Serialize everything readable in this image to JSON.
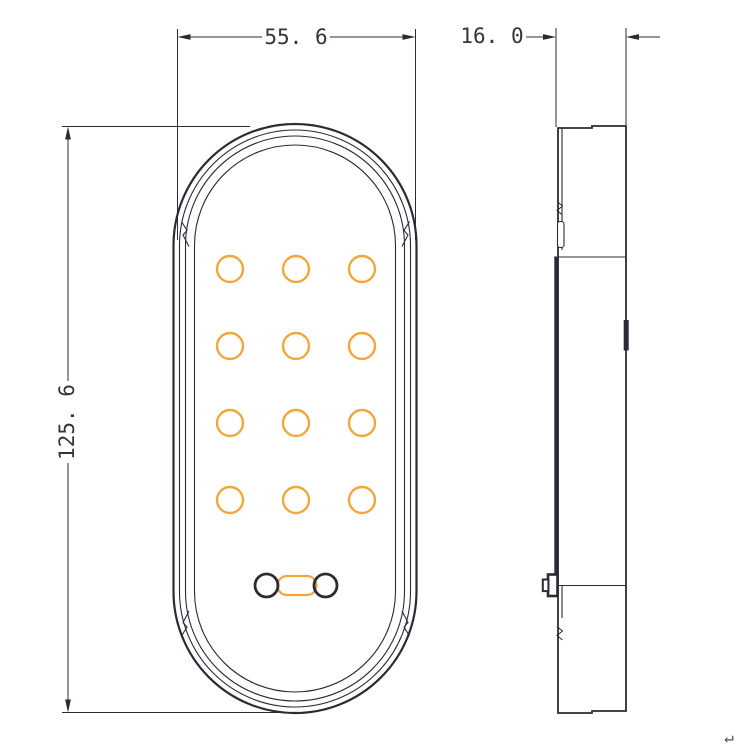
{
  "canvas": {
    "width": 750,
    "height": 750,
    "background": "#ffffff"
  },
  "colors": {
    "line": "#2b2b36",
    "accent": "#F2A63C",
    "text": "#34343f",
    "glyph": "#50505a",
    "white": "#ffffff"
  },
  "labels": {
    "width": "55. 6",
    "depth": "16. 0",
    "height": "125. 6",
    "return_glyph": "↵"
  },
  "views": [
    {
      "name": "front-view",
      "shapes": [
        {
          "t": "rect",
          "n": "front-outer-outline",
          "x": 173.5,
          "y": 124,
          "w": 243,
          "h": 589,
          "rx": 121.5,
          "sw": 2.2
        },
        {
          "t": "rect",
          "n": "front-outline-inner",
          "x": 179.5,
          "y": 130,
          "w": 231,
          "h": 577,
          "rx": 115.5,
          "sw": 1.1
        },
        {
          "t": "rect",
          "n": "front-bezel-outline",
          "x": 185.5,
          "y": 136,
          "w": 219,
          "h": 565,
          "rx": 109.5,
          "sw": 1.1
        },
        {
          "t": "rect",
          "n": "front-lens-outline",
          "x": 194.5,
          "y": 145,
          "w": 201,
          "h": 547,
          "rx": 100.5,
          "sw": 1.1
        },
        {
          "t": "path",
          "n": "front-clip-notch-top-left",
          "d": "M181.5 221.5 l5.5 9 l-4 4.5 l6 11.5",
          "sw": 1.1
        },
        {
          "t": "path",
          "n": "front-clip-notch-top-right",
          "d": "M409.5 221.5 l-5.5 9 l4 4.5 l-6 11.5",
          "sw": 1.1
        },
        {
          "t": "path",
          "n": "front-clip-notch-bottom-left",
          "d": "M181.5 636 l5.5 -9 l-4 -4.5 l6 -11.5",
          "sw": 1.1
        },
        {
          "t": "path",
          "n": "front-clip-notch-bottom-right",
          "d": "M409.5 636 l-5.5 -9 l4 -4.5 l-6 -11.5",
          "sw": 1.1
        },
        {
          "t": "led-grid",
          "n": "led-circle",
          "cols": [
            230,
            296,
            362
          ],
          "rows": [
            269,
            346,
            423,
            500
          ],
          "r": 13,
          "sw": 2.4,
          "stroke": "accent"
        },
        {
          "t": "rect",
          "n": "connector-link",
          "x": 277.5,
          "y": 576,
          "w": 39,
          "h": 19,
          "rx": 9.5,
          "sw": 2.2,
          "stroke": "accent"
        },
        {
          "t": "circle",
          "n": "connector-terminal-left",
          "cx": 266.5,
          "cy": 585.5,
          "r": 11.5,
          "sw": 2.8
        },
        {
          "t": "circle",
          "n": "connector-terminal-right",
          "cx": 325.5,
          "cy": 585.5,
          "r": 11.5,
          "sw": 2.8
        }
      ]
    },
    {
      "name": "side-view",
      "shapes": [
        {
          "t": "path",
          "n": "side-outer-outline",
          "d": "M558 128 L592 128 L592 126 L626 126 L626 711 L592 711 L592 713 L558 713 Z",
          "sw": 1.8
        },
        {
          "t": "line",
          "n": "side-inner-edge-top",
          "x1": 562,
          "y1": 128,
          "x2": 562,
          "y2": 250,
          "sw": 1.1
        },
        {
          "t": "line",
          "n": "side-inner-edge-bottom",
          "x1": 562,
          "y1": 586,
          "x2": 562,
          "y2": 618,
          "sw": 1.1
        },
        {
          "t": "path",
          "n": "side-notch-top",
          "d": "M557 201.5 l5.5 4.5 l-5.5 4.5 l5.5 4.5",
          "sw": 1
        },
        {
          "t": "rect",
          "n": "side-clip-slot",
          "x": 557.5,
          "y": 221.5,
          "w": 6.5,
          "h": 26,
          "rx": 2.5,
          "sw": 1.1,
          "fill": "white"
        },
        {
          "t": "rect",
          "n": "side-lens-edge",
          "x": 554.3,
          "y": 257,
          "w": 4.4,
          "h": 328.5,
          "fill": "line",
          "sw": 0
        },
        {
          "t": "line",
          "n": "side-seam-top",
          "x1": 554.3,
          "y1": 257,
          "x2": 626,
          "y2": 257,
          "sw": 1.1
        },
        {
          "t": "line",
          "n": "side-seam-bottom",
          "x1": 548.5,
          "y1": 585.5,
          "x2": 626,
          "y2": 585.5,
          "sw": 1.1
        },
        {
          "t": "rect",
          "n": "side-right-tick",
          "x": 623.7,
          "y": 320,
          "w": 5,
          "h": 30.5,
          "fill": "line",
          "sw": 0
        },
        {
          "t": "rect",
          "n": "side-screw-boss",
          "x": 548,
          "y": 574.5,
          "w": 9.5,
          "h": 21.5,
          "sw": 2.6,
          "fill": "white"
        },
        {
          "t": "rect",
          "n": "side-screw-head",
          "x": 542.8,
          "y": 579.5,
          "w": 5.6,
          "h": 11.6,
          "sw": 2,
          "fill": "white"
        },
        {
          "t": "path",
          "n": "side-notch-bottom",
          "d": "M557 626.5 l5.5 4.5 l-5.5 4.5 l5.5 4.5",
          "sw": 1
        }
      ]
    },
    {
      "name": "dimension-width",
      "shapes": [
        {
          "t": "line",
          "n": "extension-line",
          "x1": 177.5,
          "y1": 29,
          "x2": 177.5,
          "y2": 240,
          "sw": 1
        },
        {
          "t": "line",
          "n": "extension-line",
          "x1": 415.5,
          "y1": 29,
          "x2": 415.5,
          "y2": 240,
          "sw": 1
        },
        {
          "t": "line",
          "n": "dimension-line",
          "x1": 189,
          "y1": 37,
          "x2": 262,
          "y2": 37,
          "sw": 1
        },
        {
          "t": "line",
          "n": "dimension-line",
          "x1": 330,
          "y1": 37,
          "x2": 404,
          "y2": 37,
          "sw": 1
        },
        {
          "t": "arrow",
          "n": "arrowhead-left",
          "x": 177.5,
          "y": 37,
          "dir": "left"
        },
        {
          "t": "arrow",
          "n": "arrowhead-right",
          "x": 415.5,
          "y": 37,
          "dir": "right"
        },
        {
          "t": "text",
          "n": "dimension-label-width",
          "x": 296,
          "y": 37,
          "size": 21,
          "bind": "labels.width"
        }
      ]
    },
    {
      "name": "dimension-height",
      "shapes": [
        {
          "t": "line",
          "n": "extension-line",
          "x1": 62,
          "y1": 126.5,
          "x2": 250,
          "y2": 126.5,
          "sw": 1
        },
        {
          "t": "line",
          "n": "extension-line",
          "x1": 62,
          "y1": 712.5,
          "x2": 292,
          "y2": 712.5,
          "sw": 1
        },
        {
          "t": "line",
          "n": "dimension-line",
          "x1": 68,
          "y1": 139,
          "x2": 68,
          "y2": 381,
          "sw": 1
        },
        {
          "t": "line",
          "n": "dimension-line",
          "x1": 68,
          "y1": 463,
          "x2": 68,
          "y2": 700,
          "sw": 1
        },
        {
          "t": "arrow",
          "n": "arrowhead-top",
          "x": 68,
          "y": 126.5,
          "dir": "up"
        },
        {
          "t": "arrow",
          "n": "arrowhead-bottom",
          "x": 68,
          "y": 712.5,
          "dir": "down"
        },
        {
          "t": "text",
          "n": "dimension-label-height",
          "x": 67,
          "y": 422,
          "size": 21,
          "rot": -90,
          "bind": "labels.height"
        }
      ]
    },
    {
      "name": "dimension-depth",
      "shapes": [
        {
          "t": "text",
          "n": "dimension-label-depth",
          "x": 492,
          "y": 36,
          "size": 21,
          "bind": "labels.depth"
        },
        {
          "t": "line",
          "n": "leader-line",
          "x1": 526,
          "y1": 37,
          "x2": 544,
          "y2": 37,
          "sw": 1
        },
        {
          "t": "arrow",
          "n": "arrowhead-left-in",
          "x": 556,
          "y": 37,
          "dir": "right"
        },
        {
          "t": "line",
          "n": "extension-line",
          "x1": 556,
          "y1": 28,
          "x2": 556,
          "y2": 127,
          "sw": 1
        },
        {
          "t": "arrow",
          "n": "arrowhead-right-in",
          "x": 626,
          "y": 37,
          "dir": "left"
        },
        {
          "t": "line",
          "n": "leader-line",
          "x1": 639,
          "y1": 37,
          "x2": 660,
          "y2": 37,
          "sw": 1
        },
        {
          "t": "line",
          "n": "extension-line",
          "x1": 626,
          "y1": 28,
          "x2": 626,
          "y2": 125,
          "sw": 1
        }
      ]
    },
    {
      "name": "annotations",
      "shapes": [
        {
          "t": "text",
          "n": "return-glyph",
          "x": 729,
          "y": 737,
          "size": 16,
          "fill": "glyph",
          "bind": "labels.return_glyph"
        }
      ]
    }
  ]
}
